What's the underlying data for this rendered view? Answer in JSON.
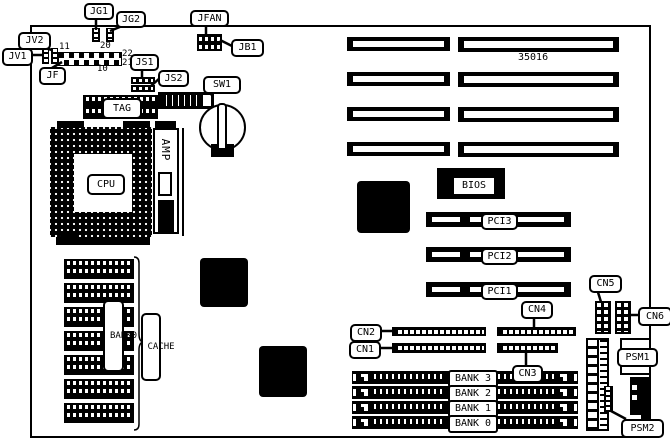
{
  "diagram": {
    "part_number": "35016",
    "labels": {
      "jg1": "JG1",
      "jg2": "JG2",
      "jfan": "JFAN",
      "jb1": "JB1",
      "jv2": "JV2",
      "jv1": "JV1",
      "jf": "JF",
      "js1": "JS1",
      "js2": "JS2",
      "sw1": "SW1",
      "tag": "TAG",
      "cpu": "CPU",
      "amp": "AMP",
      "bios": "BIOS",
      "pci3": "PCI3",
      "pci2": "PCI2",
      "pci1": "PCI1",
      "cn1": "CN1",
      "cn2": "CN2",
      "cn3": "CN3",
      "cn4": "CN4",
      "cn5": "CN5",
      "cn6": "CN6",
      "psm1": "PSM1",
      "psm2": "PSM2",
      "cache": "CACHE",
      "bank0_chips": "BANK0"
    },
    "jf_pins": {
      "p11": "11",
      "p20": "20",
      "p22": "22",
      "p21": "21",
      "p10": "10"
    },
    "memory_banks": [
      "BANK 3",
      "BANK 2",
      "BANK 1",
      "BANK 0"
    ]
  }
}
